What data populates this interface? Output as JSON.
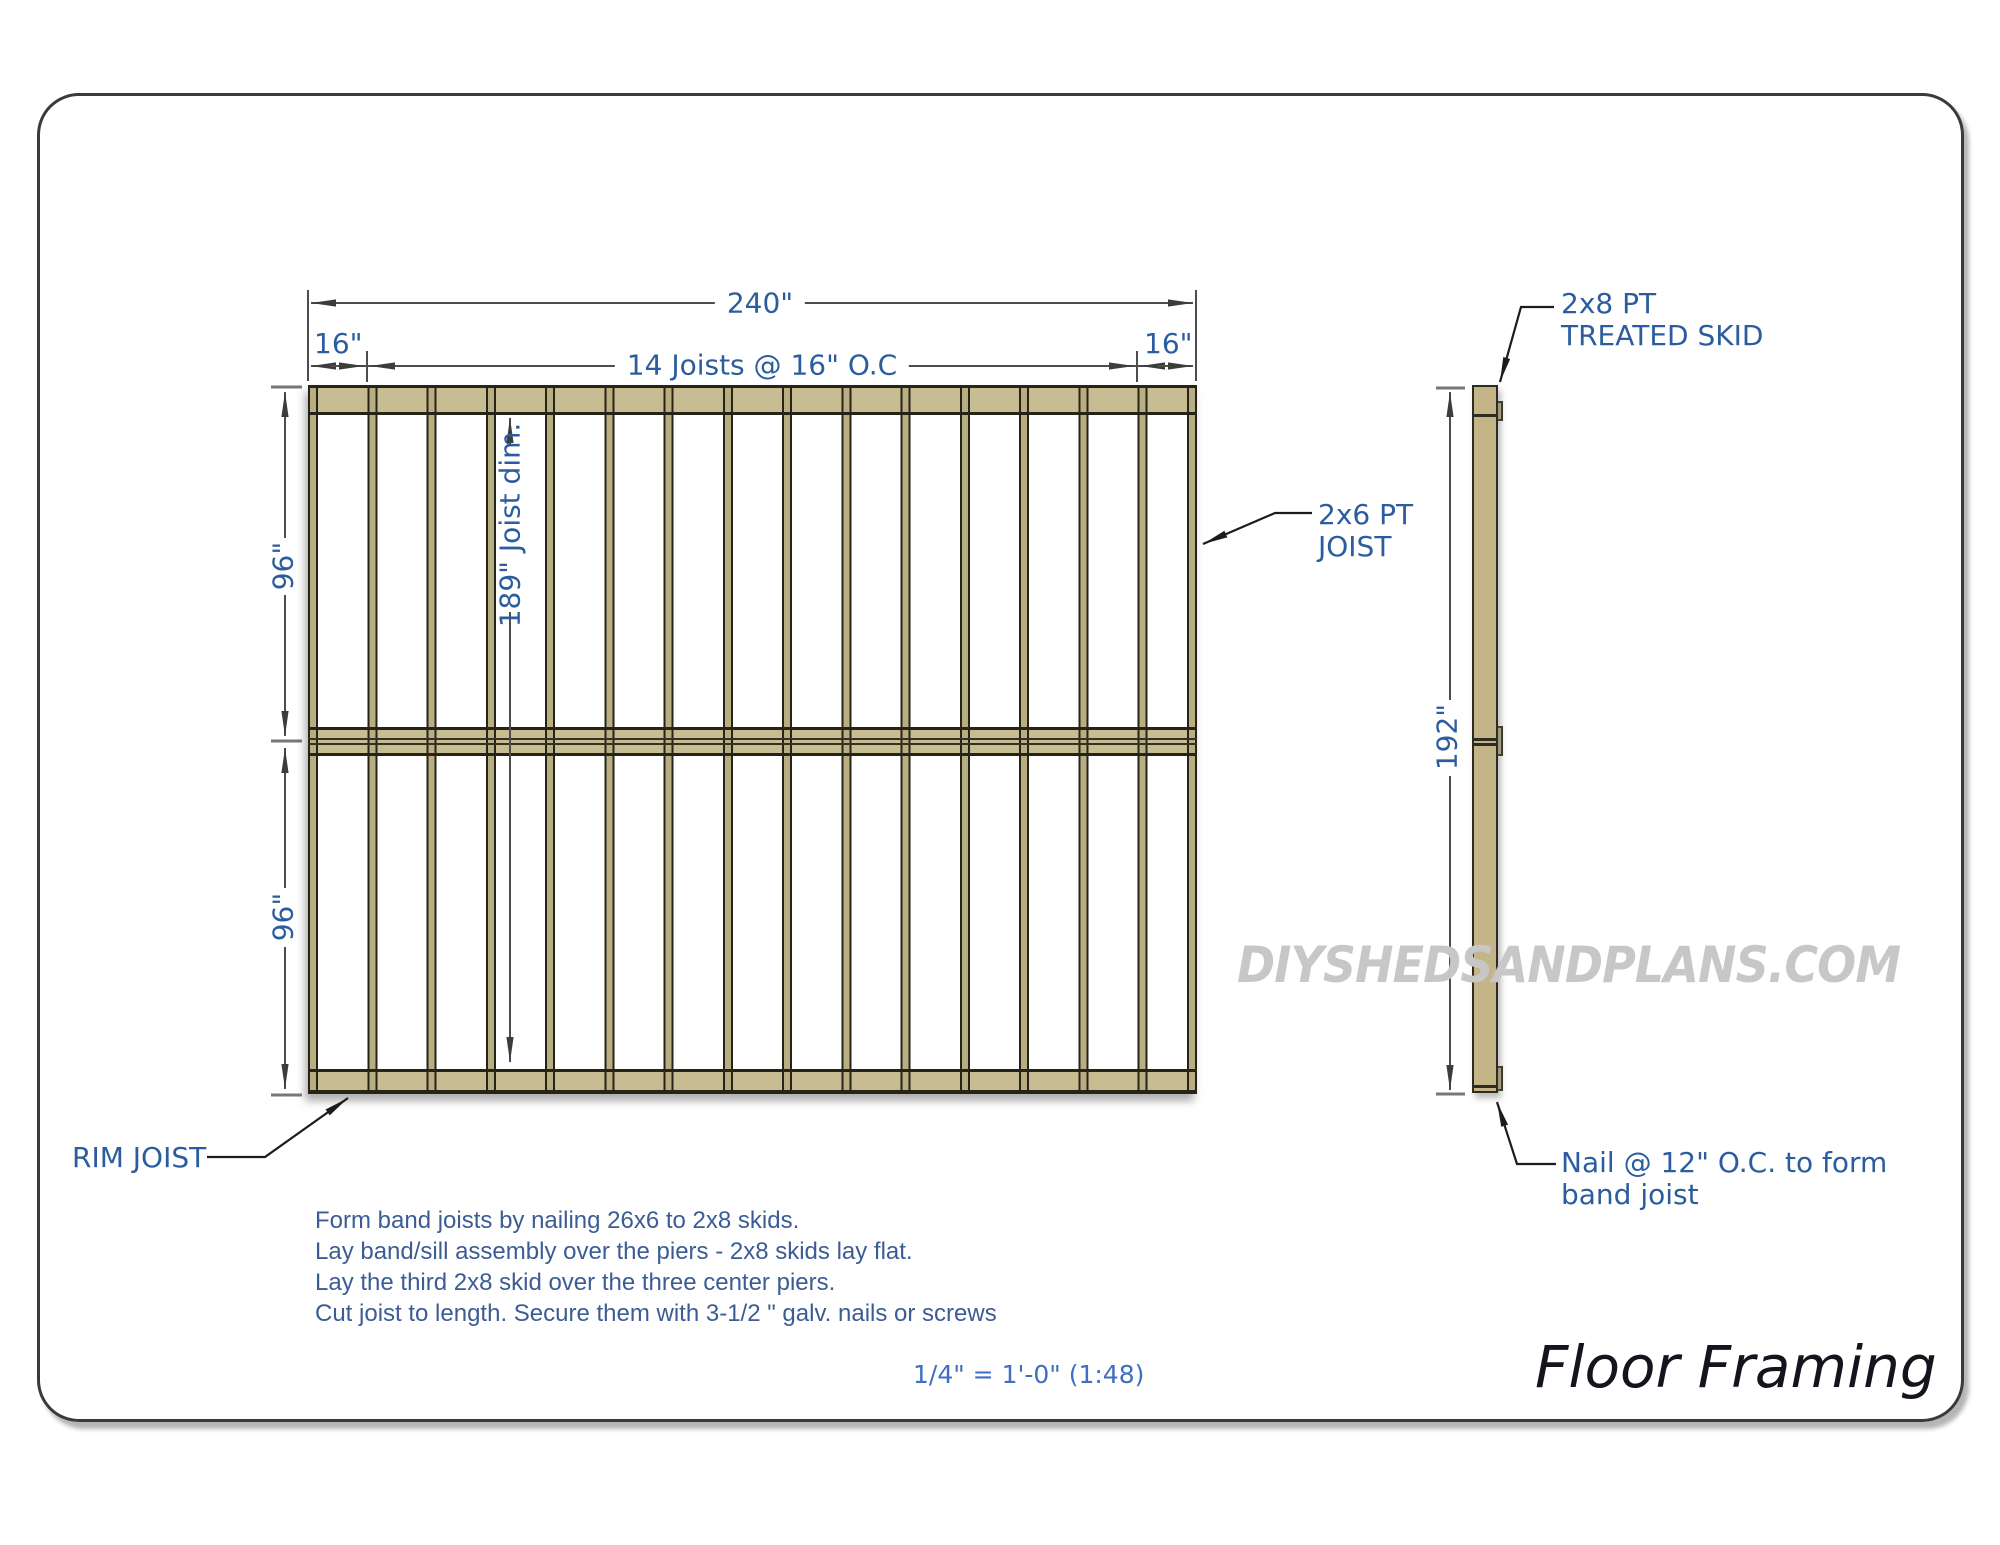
{
  "drawing": {
    "title": "Floor Framing",
    "scale": "1/4\" = 1'-0\" (1:48)",
    "watermark": "DIYSHEDSANDPLANS.COM"
  },
  "plan_view": {
    "dim_overall_width": "240\"",
    "dim_left_bay": "16\"",
    "dim_right_bay": "16\"",
    "dim_joist_layout": "14 Joists @ 16\" O.C",
    "dim_upper_half": "96\"",
    "dim_lower_half": "96\"",
    "dim_joist_length": "189\" Joist dim.",
    "label_rim_joist": "RIM JOIST",
    "label_joist_line1": "2x6 PT",
    "label_joist_line2": "JOIST",
    "joist_count_label": 14,
    "vertical_members_drawn": 16
  },
  "side_view": {
    "dim_length": "192\"",
    "label_skid_line1": "2x8 PT",
    "label_skid_line2": "TREATED SKID",
    "label_nail_line1": "Nail @ 12\" O.C. to form",
    "label_nail_line2": "band joist"
  },
  "notes": {
    "line1": "Form band joists by nailing 26x6 to 2x8 skids.",
    "line2": "Lay band/sill assembly over the piers - 2x8 skids lay flat.",
    "line3": "Lay the third 2x8 skid over the three center piers.",
    "line4": "Cut joist to length. Secure them with 3-1/2 \" galv. nails or screws"
  },
  "colors": {
    "lumber_band_fill": "#c8bc92",
    "joist_fill": "#b9ad82",
    "lumber_outline": "#262418",
    "dimension_text": "#2b5d9e",
    "note_text": "#3c5c94",
    "dimension_line": "#4d4d4d",
    "leader_line": "#1c1c1c",
    "watermark_gray": "#c7c7c7"
  }
}
